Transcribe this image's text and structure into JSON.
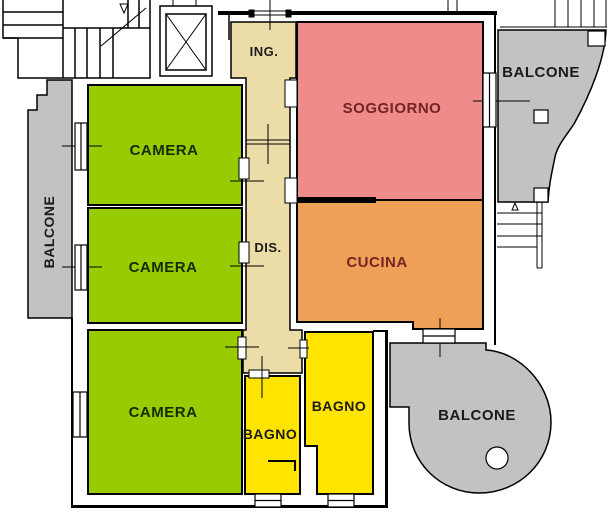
{
  "colors": {
    "wall": "#000000",
    "camera_green": "#98CB00",
    "soggiorno_pink": "#EE8C8C",
    "cucina_orange": "#EFA057",
    "bagno_yellow": "#FFE400",
    "corridor_beige": "#EBDCA8",
    "balcone_gray": "#C2C2C2",
    "label_dark_red": "#742424",
    "label_dark": "#1A1A1A",
    "label_green_dark": "#152B00"
  },
  "rooms": {
    "ing": {
      "label": "ING."
    },
    "dis": {
      "label": "DIS."
    },
    "soggiorno": {
      "label": "SOGGIORNO"
    },
    "cucina": {
      "label": "CUCINA"
    },
    "camera1": {
      "label": "CAMERA"
    },
    "camera2": {
      "label": "CAMERA"
    },
    "camera3": {
      "label": "CAMERA"
    },
    "bagno_small": {
      "label": "BAGNO"
    },
    "bagno_large": {
      "label": "BAGNO"
    }
  },
  "balconies": {
    "left": {
      "label": "BALCONE"
    },
    "top_right": {
      "label": "BALCONE"
    },
    "bottom_right": {
      "label": "BALCONE"
    }
  }
}
